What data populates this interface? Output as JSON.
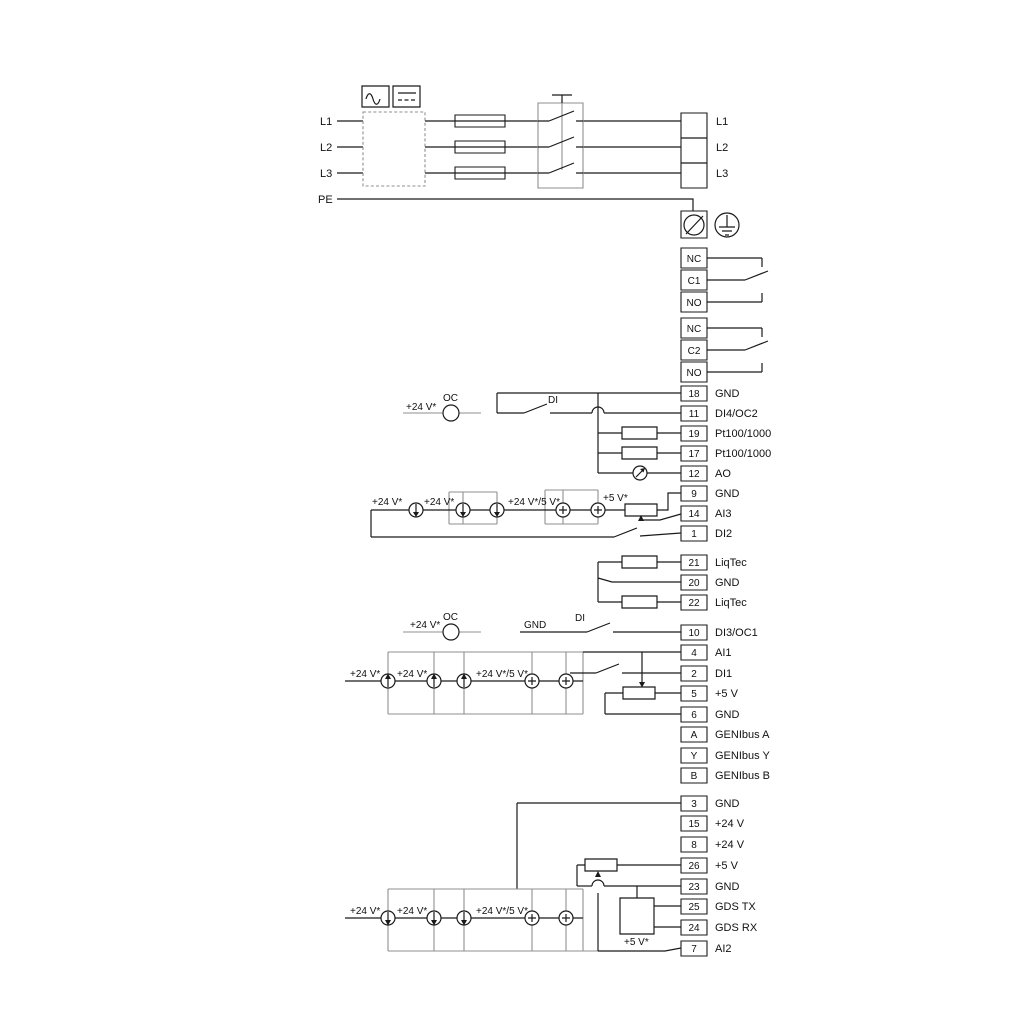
{
  "labels": {
    "l1": "L1",
    "l2": "L2",
    "l3": "L3",
    "pe": "PE",
    "v24": "+24 V*",
    "v24_5": "+24 V*/5 V*",
    "v5": "+5 V*",
    "oc": "OC",
    "di": "DI",
    "gnd": "GND"
  },
  "mains_out": [
    "L1",
    "L2",
    "L3"
  ],
  "relay1": [
    "NC",
    "C1",
    "NO"
  ],
  "relay2": [
    "NC",
    "C2",
    "NO"
  ],
  "io1": [
    {
      "num": "18",
      "label": "GND"
    },
    {
      "num": "11",
      "label": "DI4/OC2"
    },
    {
      "num": "19",
      "label": "Pt100/1000"
    },
    {
      "num": "17",
      "label": "Pt100/1000"
    },
    {
      "num": "12",
      "label": "AO"
    },
    {
      "num": "9",
      "label": "GND"
    },
    {
      "num": "14",
      "label": "AI3"
    },
    {
      "num": "1",
      "label": "DI2"
    }
  ],
  "liqtec": [
    {
      "num": "21",
      "label": "LiqTec"
    },
    {
      "num": "20",
      "label": "GND"
    },
    {
      "num": "22",
      "label": "LiqTec"
    }
  ],
  "io2": [
    {
      "num": "10",
      "label": "DI3/OC1"
    },
    {
      "num": "4",
      "label": "AI1"
    },
    {
      "num": "2",
      "label": "DI1"
    },
    {
      "num": "5",
      "label": "+5 V"
    },
    {
      "num": "6",
      "label": "GND"
    },
    {
      "num": "A",
      "label": "GENIbus A"
    },
    {
      "num": "Y",
      "label": "GENIbus Y"
    },
    {
      "num": "B",
      "label": "GENIbus B"
    }
  ],
  "io3": [
    {
      "num": "3",
      "label": "GND"
    },
    {
      "num": "15",
      "label": "+24 V"
    },
    {
      "num": "8",
      "label": "+24 V"
    },
    {
      "num": "26",
      "label": "+5 V"
    },
    {
      "num": "23",
      "label": "GND"
    },
    {
      "num": "25",
      "label": "GDS TX"
    },
    {
      "num": "24",
      "label": "GDS RX"
    },
    {
      "num": "7",
      "label": "AI2"
    }
  ],
  "colors": {
    "wire": "#1a1a1a",
    "rail": "#8f8f8f"
  }
}
